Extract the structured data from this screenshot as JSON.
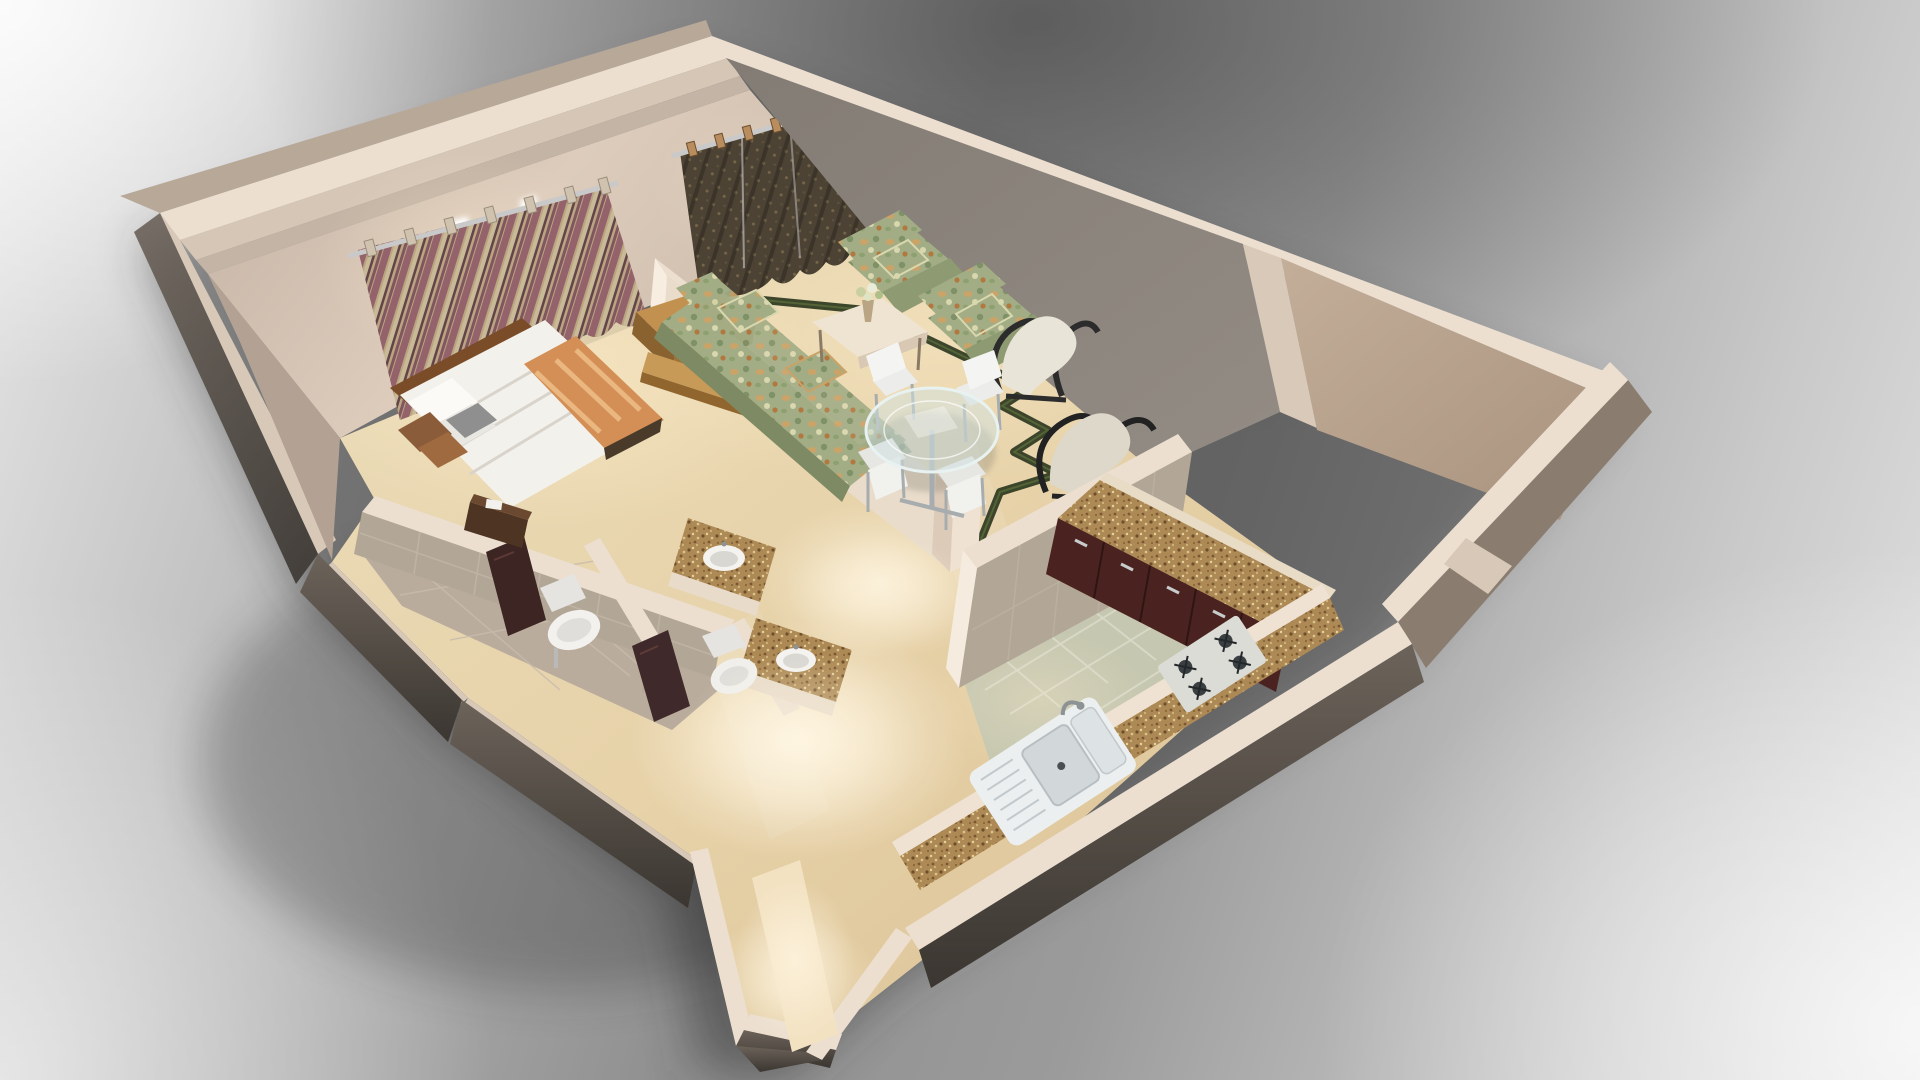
{
  "scene": {
    "type": "3d-floorplan-render",
    "title": "3D cutaway floor plan of a one-bedroom apartment",
    "camera": "elevated south-east isometric view on gray studio backdrop",
    "rooms": [
      {
        "name": "bedroom",
        "items": [
          "double-bed",
          "white-duvet",
          "orange-patterned-runner",
          "pillows",
          "dark-nightstand",
          "wood-tv-console",
          "wood-wall-shelf",
          "striped-mauve-curtains",
          "window-light"
        ]
      },
      {
        "name": "living-room",
        "items": [
          "floral-three-seat-sofa",
          "floral-armchair",
          "floral-armchair",
          "cream-coffee-table",
          "flower-vase",
          "olive-patterned-curtains",
          "cream-lounge-chair",
          "black-frame-lounge-chair",
          "zigzag-green-floor-border",
          "gray-accent-wall"
        ]
      },
      {
        "name": "dining-area",
        "items": [
          "round-glass-table",
          "chrome-pedestal",
          "white-dining-chair",
          "white-dining-chair",
          "white-dining-chair",
          "white-dining-chair"
        ]
      },
      {
        "name": "kitchen",
        "items": [
          "l-shaped-granite-counter",
          "maroon-cabinets",
          "double-basin-sink",
          "four-burner-gas-hob",
          "tiled-half-wall",
          "sage-tile-floor"
        ]
      },
      {
        "name": "bathroom-1",
        "items": [
          "wall-hung-toilet",
          "granite-vanity",
          "round-vessel-basin",
          "dark-door"
        ]
      },
      {
        "name": "bathroom-2",
        "items": [
          "toilet",
          "granite-vanity",
          "round-vessel-basin",
          "dark-door"
        ]
      },
      {
        "name": "entry-hall",
        "items": [
          "marble-floor",
          "ceiling-light-glow",
          "entry-door-walls"
        ]
      }
    ],
    "palette": {
      "wall_top": "#ecdfd0",
      "wall_top_dim": "#d8c8b8",
      "wall_beige": "#d5c4b5",
      "wall_gray": "#8a837b",
      "wall_tan": "#b6a18c",
      "wall_dark": "#5d554d",
      "floor_marble": "#e7d4ae",
      "kitchen_tile": "#c6c7b0",
      "bath_tile": "#b2a696",
      "granite": "#ad8a55",
      "cabinet": "#4a2320",
      "sofa_floral": "#a2ad86",
      "curtain_mauve": "#a06b74",
      "curtain_cream": "#d9caa4",
      "curtain_olive": "#4d4335",
      "wood": "#c2914f",
      "bed_white": "#f3f1ec",
      "runner_orange": "#d38f55",
      "zigzag_green": "#2c3820",
      "chrome": "#a7acae",
      "background_dark": "#6e6e6e",
      "background_light": "#ededed"
    }
  }
}
